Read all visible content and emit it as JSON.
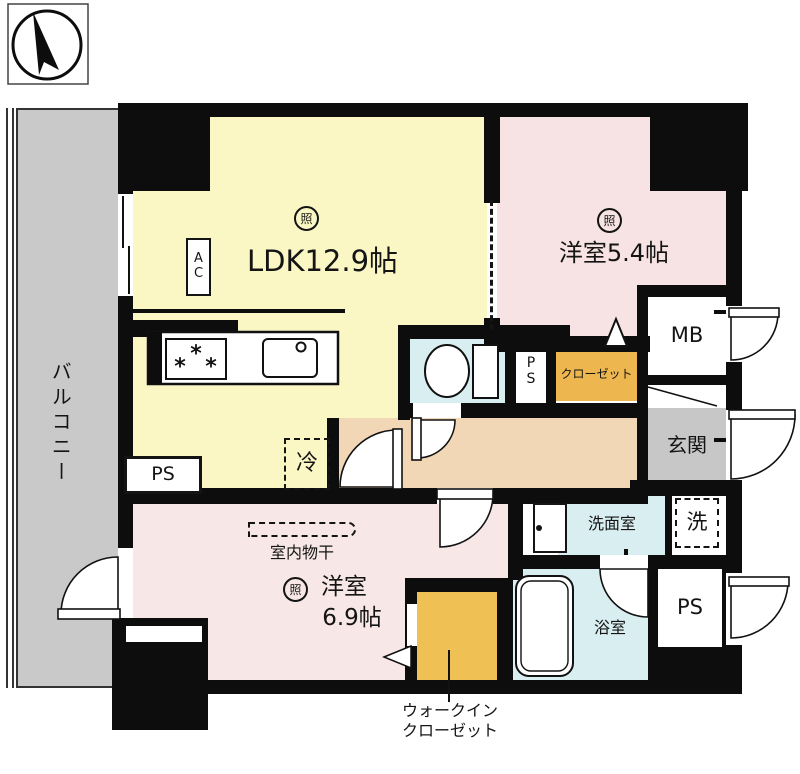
{
  "labels": {
    "balcony": "バルコニー",
    "ldk": "LDK12.9帖",
    "ac": "A\nC",
    "light": "照",
    "bedroom1": "洋室5.4帖",
    "bedroom2_name": "洋室",
    "bedroom2_size": "6.9帖",
    "laundry_rack": "室内物干",
    "closet": "クローゼット",
    "wic_line1": "ウォークイン",
    "wic_line2": "クローゼット",
    "meter_box": "MB",
    "entrance": "玄関",
    "washroom": "洗面室",
    "bathroom": "浴室",
    "washer": "洗",
    "refrigerator": "冷",
    "pipe_space": "PS",
    "pipe_space_vertical": "P\nS"
  },
  "colors": {
    "wall": "#0d0d0d",
    "ldk": "#fbf7c5",
    "bedroom1": "#f7e3e3",
    "bedroom2": "#f8e7e7",
    "corridor": "#f2d7b7",
    "wet": "#d9eef0",
    "closet": "#eeb64e",
    "wic": "#efc054",
    "genkan": "#c7c7c7",
    "balcony": "#c9c9c9"
  }
}
